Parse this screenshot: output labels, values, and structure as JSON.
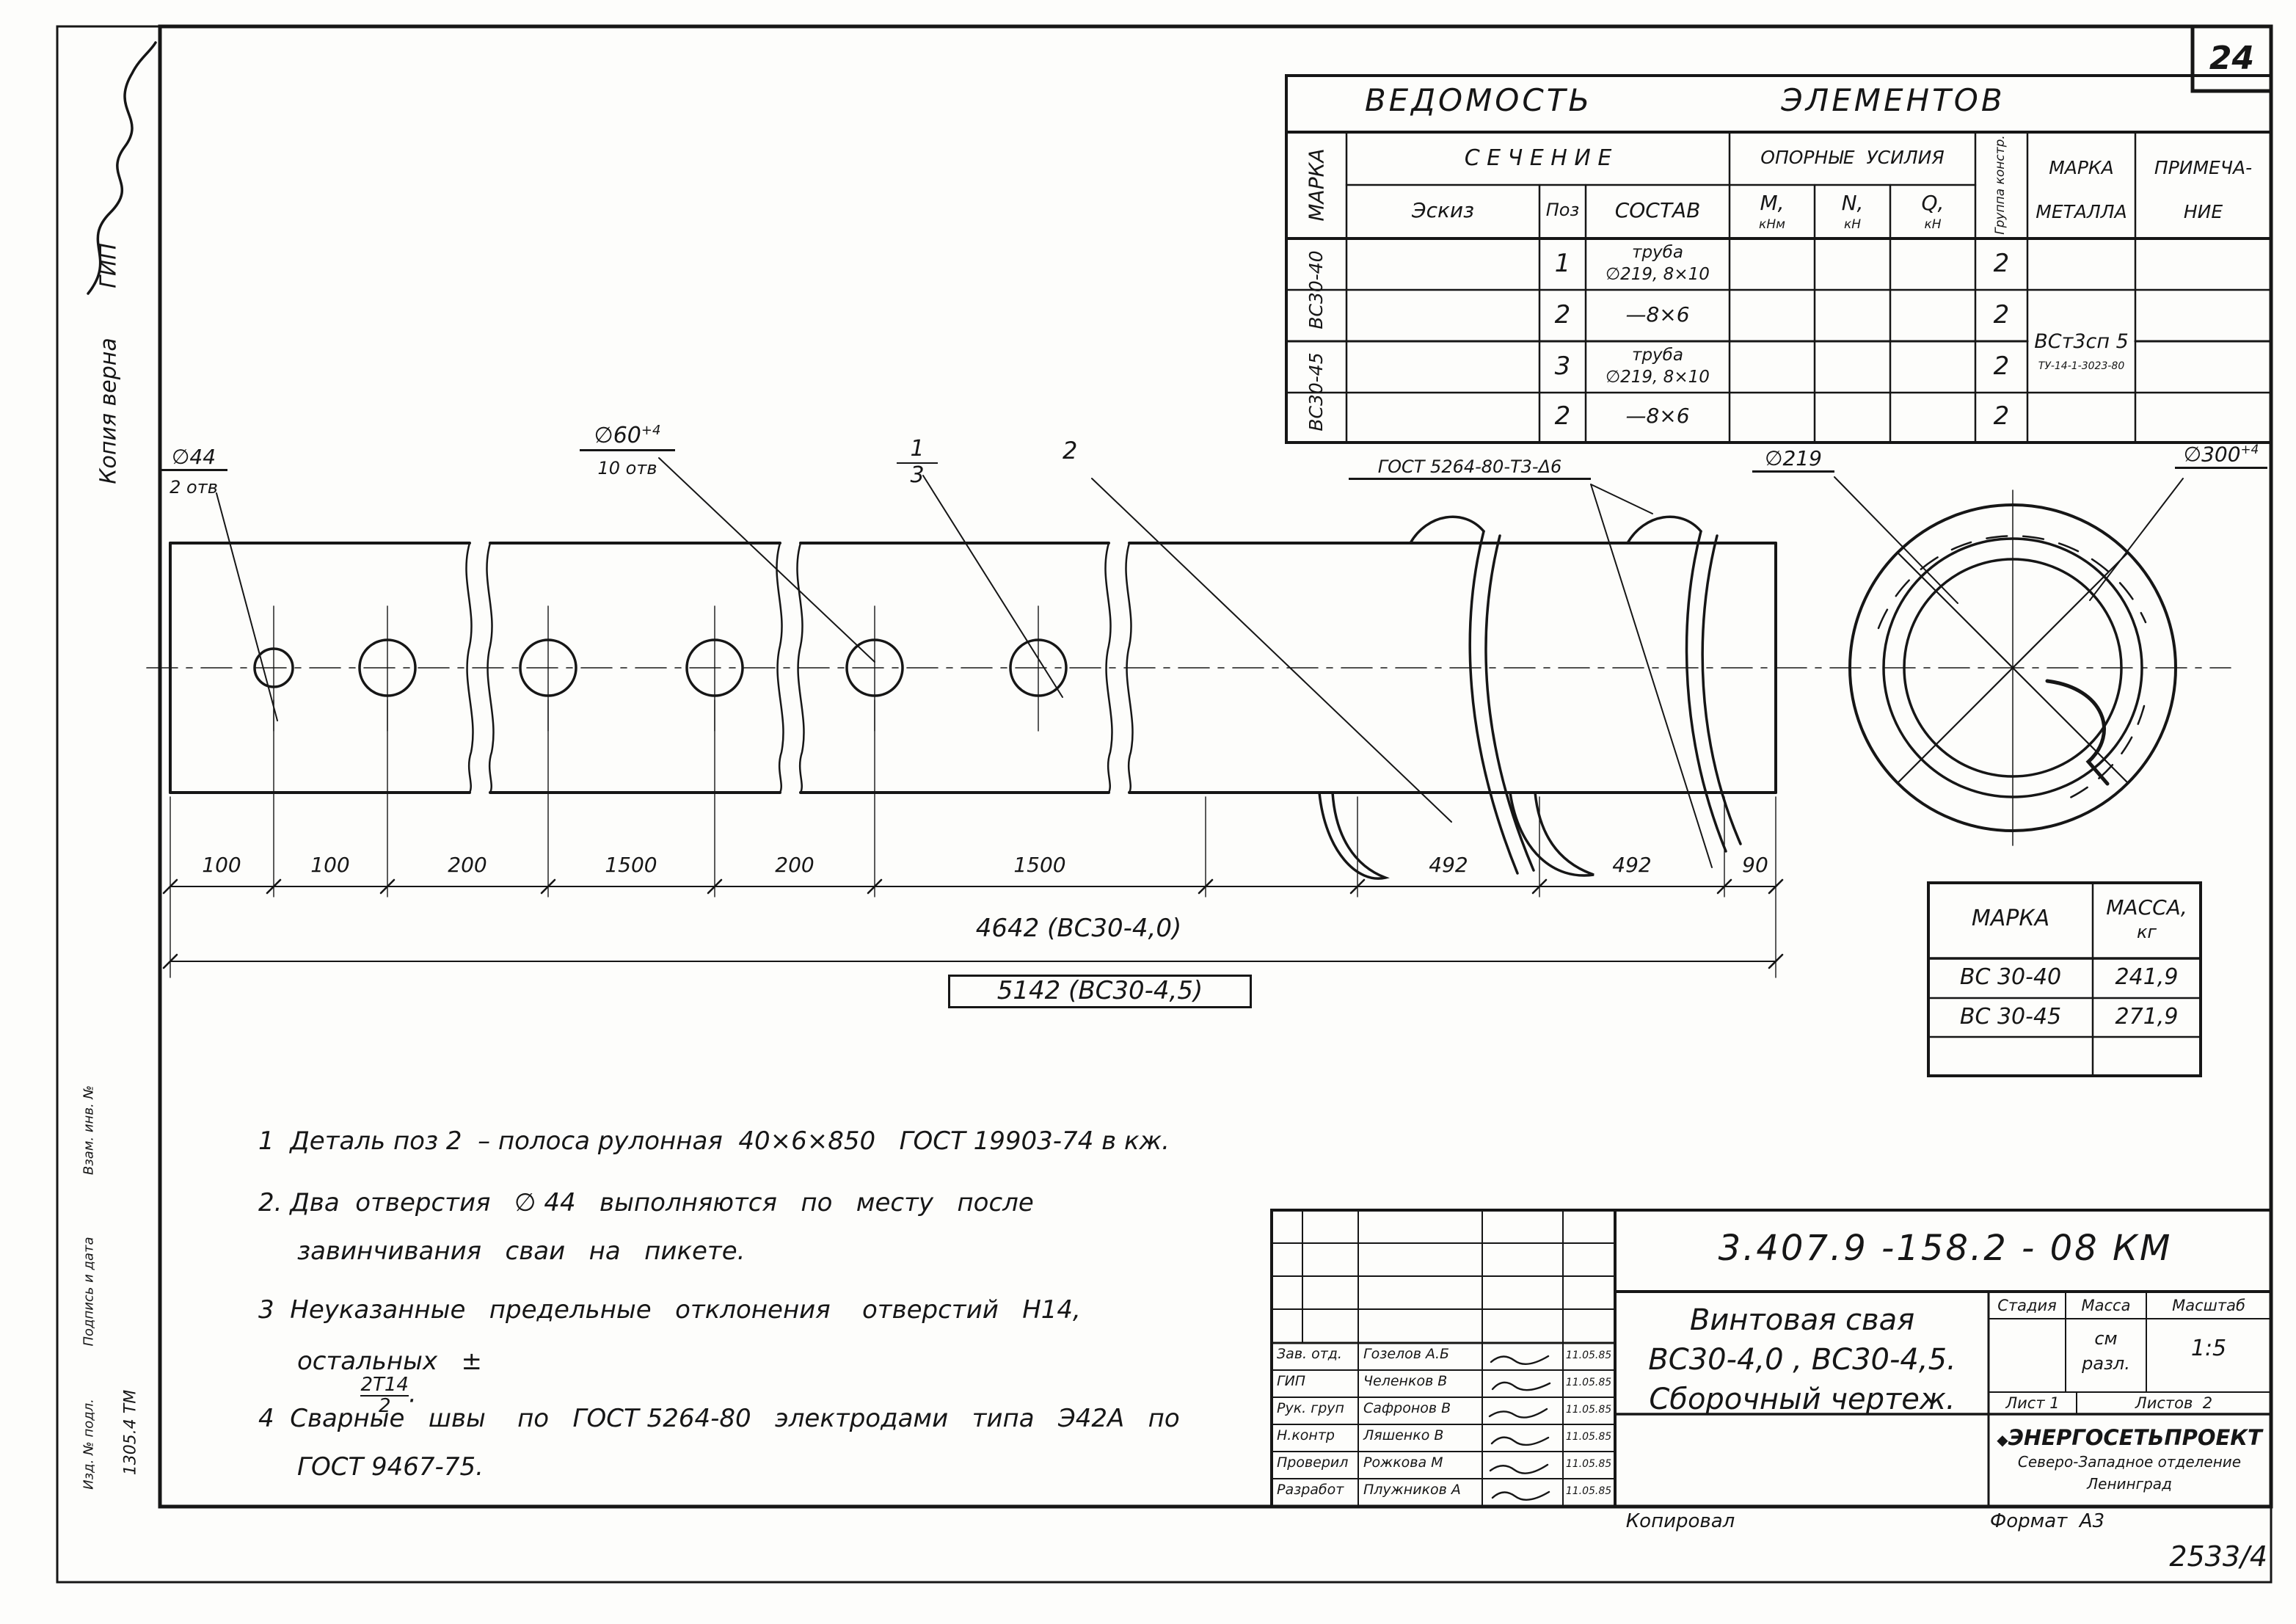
{
  "page": {
    "sheet_number": "24",
    "archive_number": "2533/4",
    "kopiroval": "Копировал",
    "format": "Формат  А3"
  },
  "margin": {
    "copy_note": "Копия верна",
    "copy_role": "ГИП",
    "stamp_1": "Взам. инв. №",
    "stamp_2": "Подпись и дата",
    "stamp_3": "Изд. № подл.",
    "inventory_number": "1305.4 ТМ"
  },
  "vedomost": {
    "title_1": "ВЕДОМОСТЬ",
    "title_2": "ЭЛЕМЕНТОВ",
    "col_marka": "МАРКА",
    "col_sechenie": "С Е Ч Е Н И Е",
    "col_oporn": "ОПОРНЫЕ  УСИЛИЯ",
    "col_gruppa": "Группа констр.",
    "col_marka_met_1": "МАРКА",
    "col_marka_met_2": "МЕТАЛЛА",
    "col_primech_1": "ПРИМЕЧА-",
    "col_primech_2": "НИЕ",
    "col_eskiz": "Эскиз",
    "col_poz": "Поз",
    "col_sostav": "СОСТАВ",
    "col_m": "М,",
    "col_m_u": "кНм",
    "col_n": "N,",
    "col_n_u": "кН",
    "col_q": "Q,",
    "col_q_u": "кН",
    "group_1": "ВС30-40",
    "group_2": "ВС30-45",
    "rows": [
      {
        "poz": "1",
        "sostav_1": "труба",
        "sostav_2": "∅219, 8×10",
        "gruppa": "2"
      },
      {
        "poz": "2",
        "sostav_1": "—8×6",
        "sostav_2": "",
        "gruppa": "2"
      },
      {
        "poz": "3",
        "sostav_1": "труба",
        "sostav_2": "∅219, 8×10",
        "gruppa": "2"
      },
      {
        "poz": "2",
        "sostav_1": "—8×6",
        "sostav_2": "",
        "gruppa": "2"
      }
    ],
    "metal_1": "ВСт3сп 5",
    "metal_2": "ТУ-14-1-3023-80"
  },
  "drawing": {
    "dia44": "∅44",
    "dia44_qty": "2 отв",
    "dia60": "∅60",
    "dia60_sup": "+4",
    "dia60_qty": "10 отв",
    "callout_13_top": "1",
    "callout_13_bottom": "3",
    "callout_2": "2",
    "weld": "ГОСТ 5264-80-Т3-Δ6",
    "dia219": "∅219",
    "dia300": "∅300",
    "dia300_sup": "+4",
    "dims_main": [
      "100",
      "100",
      "200",
      "1500",
      "200",
      "1500"
    ],
    "dims_helix": [
      "492",
      "492",
      "90"
    ],
    "total_1": "4642 (ВС30-4,0)",
    "total_2": "5142 (ВС30-4,5)"
  },
  "mass_table": {
    "col_marka": "МАРКА",
    "col_massa_1": "МАССА,",
    "col_massa_2": "кг",
    "rows": [
      {
        "marka": "ВС 30-40",
        "massa": "241,9"
      },
      {
        "marka": "ВС 30-45",
        "massa": "271,9"
      },
      {
        "marka": "",
        "massa": ""
      }
    ]
  },
  "notes": {
    "n1": "1  Деталь поз 2  – полоса рулонная  40×6×850   ГОСТ 19903-74 в кж.",
    "n2a": "2. Два  отверстия   ∅ 44   выполняются   по   месту   после",
    "n2b": "завинчивания   сваи   на   пикете.",
    "n3a": "3  Неуказанные   предельные   отклонения    отверстий   Н14,",
    "n3b": "остальных   ±",
    "n3_num": "2Т14",
    "n3_den": "2",
    "n3_end": ".",
    "n4a": "4  Сварные   швы    по   ГОСТ 5264-80   электродами   типа   Э42А   по",
    "n4b": "ГОСТ 9467-75."
  },
  "titleblock": {
    "doc_number": "3.407.9 -158.2 - 08 КМ",
    "title_1": "Винтовая свая",
    "title_2": "ВС30-4,0 , ВС30-4,5.",
    "title_3": "Сборочный чертеж.",
    "stage_h": "Стадия",
    "mass_h": "Масса",
    "scale_h": "Масштаб",
    "mass_1": "см",
    "mass_2": "разл.",
    "scale": "1:5",
    "sheet": "Лист 1",
    "sheets": "Листов  2",
    "org_logo": "◆",
    "org_1": "ЭНЕРГОСЕТЬПРОЕКТ",
    "org_2": "Северо-Западное отделение",
    "org_3": "Ленинград",
    "signatures": [
      {
        "role": "Зав. отд.",
        "name": "Гозелов А.Б",
        "date": "11.05.85"
      },
      {
        "role": "ГИП",
        "name": "Челенков В",
        "date": "11.05.85"
      },
      {
        "role": "Рук. груп",
        "name": "Сафронов В",
        "date": "11.05.85"
      },
      {
        "role": "Н.контр",
        "name": "Ляшенко В",
        "date": "11.05.85"
      },
      {
        "role": "Проверил",
        "name": "Рожкова М",
        "date": "11.05.85"
      },
      {
        "role": "Разработ",
        "name": "Плужников А",
        "date": "11.05.85"
      }
    ]
  }
}
